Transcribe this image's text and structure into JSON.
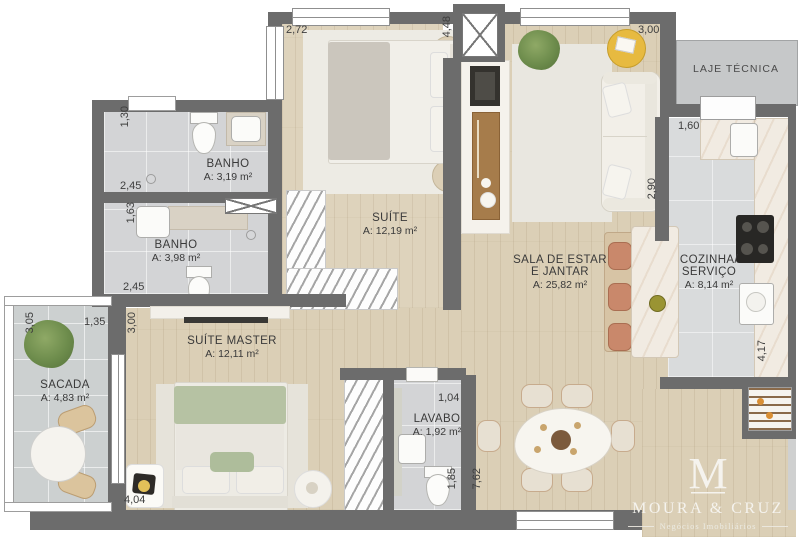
{
  "rooms": [
    {
      "id": "banho-1",
      "line1": "BANHO",
      "area": "A: 3,19 m²"
    },
    {
      "id": "banho-2",
      "line1": "BANHO",
      "area": "A: 3,98 m²"
    },
    {
      "id": "suite",
      "line1": "SUÍTE",
      "area": "A: 12,19 m²"
    },
    {
      "id": "sala",
      "line1": "SALA DE ESTAR",
      "line2": "E JANTAR",
      "area": "A: 25,82 m²"
    },
    {
      "id": "cozinha",
      "line1": "COZINHA/",
      "line2": "SERVIÇO",
      "area": "A: 8,14 m²"
    },
    {
      "id": "suite-master",
      "line1": "SUÍTE MASTER",
      "area": "A: 12,11 m²"
    },
    {
      "id": "sacada",
      "line1": "SACADA",
      "area": "A: 4,83 m²"
    },
    {
      "id": "lavabo",
      "line1": "LAVABO",
      "area": "A: 1,92 m²"
    },
    {
      "id": "laje-tecnica",
      "line1": "LAJE TÉCNICA"
    }
  ],
  "dims": [
    "2,72",
    "4,48",
    "3,00",
    "1,30",
    "2,45",
    "1,63",
    "2,45",
    "3,05",
    "1,35",
    "3,00",
    "2,90",
    "1,60",
    "4,17",
    "1,04",
    "1,85",
    "7,62",
    "4,04"
  ],
  "logo": {
    "monogram": "M",
    "name": "MOURA & CRUZ",
    "tagline": "Negócios Imobiliários"
  },
  "colors": {
    "wall": "#6c6c6c",
    "wood_floor": "#dbcfb6",
    "tile_floor": "#d3d4d6",
    "kitchen_floor": "#d9dbdc",
    "laje_floor": "#c6c8c9",
    "accent_yellow": "#e7ba40",
    "accent_terracotta": "#c9886b",
    "plant_green": "#6d8c4c",
    "bed_throw_green": "#b6c2a3",
    "logo_text": "#f5f3ee"
  }
}
